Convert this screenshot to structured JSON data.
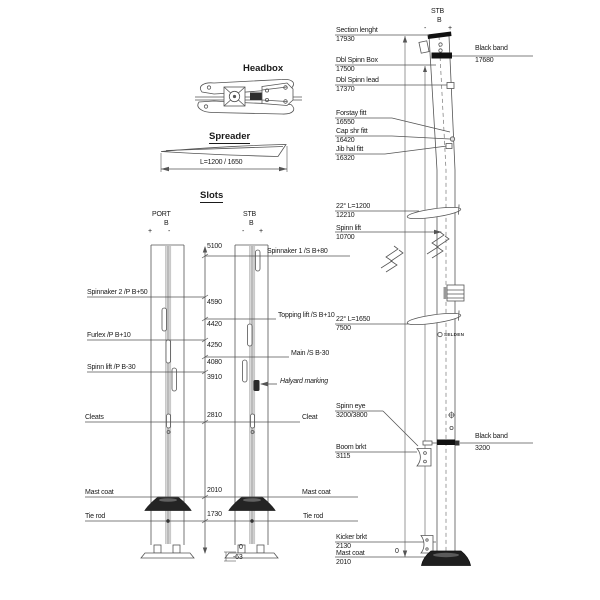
{
  "palette": {
    "ink": "#1a1a1a",
    "line": "#555555",
    "dark_fill": "#1f1f1f"
  },
  "headbox": {
    "title": "Headbox"
  },
  "spreader": {
    "title": "Spreader",
    "dim_label": "L=1200 / 1650"
  },
  "slots": {
    "title": "Slots",
    "port": {
      "name": "PORT",
      "sub": "B",
      "plus": "+",
      "minus": "-"
    },
    "stb": {
      "name": "STB",
      "sub": "B",
      "minus": "-",
      "plus": "+"
    },
    "left_labels": [
      "Spinnaker 2 /P B+50",
      "Furlex /P B+10",
      "Spinn lift /P B-30",
      "Cleats",
      "Mast coat",
      "Tie rod"
    ],
    "right_labels": [
      "Spinnaker 1 /S B+80",
      "Topping lift /S B+10",
      "Main /S B-30",
      "Halyard marking",
      "Cleat",
      "Mast coat",
      "Tie rod"
    ],
    "dims": [
      "5100",
      "4590",
      "4420",
      "4250",
      "4080",
      "3910",
      "2810",
      "2010",
      "1730",
      "0",
      "-63"
    ]
  },
  "mast": {
    "header": {
      "name": "STB",
      "sub": "B",
      "minus": "-",
      "plus": "+"
    },
    "left_callouts": [
      {
        "label": "Section lenght",
        "value": "17930"
      },
      {
        "label": "Dbl Spinn Box",
        "value": "17500"
      },
      {
        "label": "Dbl Spinn lead",
        "value": "17370"
      },
      {
        "label": "Forstay fitt",
        "value": "16550"
      },
      {
        "label": "Cap shr fitt",
        "value": "16420"
      },
      {
        "label": "Jib hal fitt",
        "value": "16320"
      },
      {
        "label": "22° L=1200",
        "value": "12210"
      },
      {
        "label": "Spinn lift",
        "value": "10700"
      },
      {
        "label": "22° L=1650",
        "value": "7500"
      },
      {
        "label": "Spinn eye",
        "value": "3200/3800"
      },
      {
        "label": "Boom brkt",
        "value": "3115"
      },
      {
        "label": "Kicker brkt",
        "value": "2130"
      },
      {
        "label": "Mast coat",
        "value": "2010"
      }
    ],
    "right_callouts": [
      {
        "label": "Black band",
        "value": "17680"
      },
      {
        "label": "Black band",
        "value": "3200"
      }
    ],
    "zero_label": "0",
    "brand": "SELDEN"
  }
}
